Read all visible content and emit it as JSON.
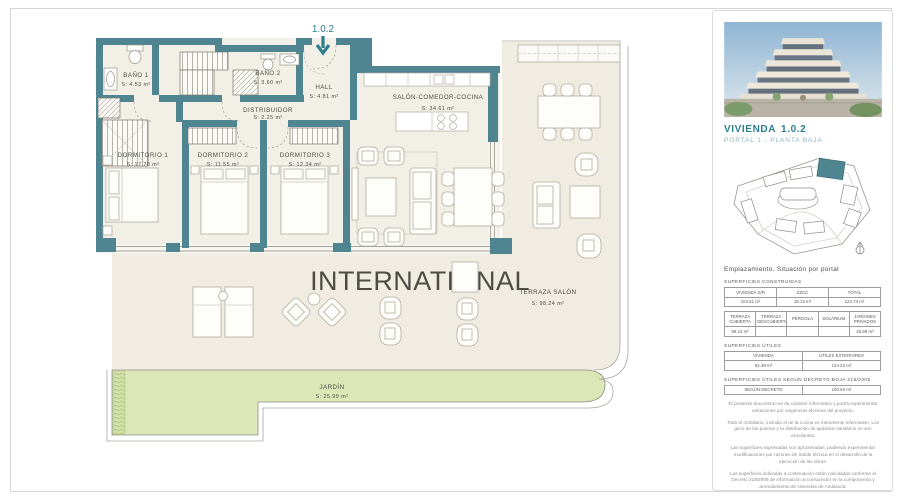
{
  "plan": {
    "unit_label": "1.0.2",
    "watermark": "INTERNATIONAL",
    "rooms": [
      {
        "name": "BAÑO 1",
        "area": "S: 4.53  m²"
      },
      {
        "name": "BAÑO 2",
        "area": "S: 3.60  m²"
      },
      {
        "name": "HALL",
        "area": "S: 4.81  m²"
      },
      {
        "name": "DISTRIBUIDOR",
        "area": "S: 2.25  m²"
      },
      {
        "name": "DORMITORIO 1",
        "area": "S: 17.70 m²"
      },
      {
        "name": "DORMITORIO 2",
        "area": "S: 11.55 m²"
      },
      {
        "name": "DORMITORIO 3",
        "area": "S: 12.34 m²"
      },
      {
        "name": "SALÓN-COMEDOR-COCINA",
        "area": "S: 34.61  m²"
      },
      {
        "name": "TERRAZA SALÓN",
        "area": "S: 98.24  m²"
      },
      {
        "name": "JARDÍN",
        "area": "S: 25.99  m²"
      }
    ]
  },
  "sidebar": {
    "title": "VIVIENDA",
    "unit_number": "1.0.2",
    "subtitle": "PORTAL 1 - PLANTA BAJA",
    "siteplan_caption": "Emplazamiento. Situación por portal",
    "sections": {
      "constructed": "SUPERFICIES CONSTRUIDAS",
      "useful": "SUPERFICIES ÚTILES",
      "decree": "SUPERFICIES ÚTILES SEGÚN DECRETO BOJA 218/2005"
    },
    "tables": {
      "constructed": {
        "headers": [
          "VIVIENDA S/R",
          "ZZCC",
          "TOTAL"
        ],
        "values": [
          "104.61 m²",
          "18.13 m²",
          "122.74 m²"
        ]
      },
      "exterior": {
        "headers": [
          "TERRAZA CUBIERTA",
          "TERRAZA DESCUBIERTA",
          "PÉRGOLA",
          "SOLÁRIUM",
          "JARDINES PRIVADOS"
        ],
        "values": [
          "98.24 m²",
          "",
          "",
          "",
          "25.99 m²"
        ]
      },
      "useful": {
        "headers": [
          "VIVIENDA",
          "ÚTILES EXTERIORES"
        ],
        "values": [
          "91.39 m²",
          "124.23 m²"
        ]
      },
      "decree": {
        "headers": [
          "SEGÚN DECRETO"
        ],
        "values": [
          "100.53 m²"
        ]
      }
    },
    "disclaimers": [
      "El presente documento es de carácter informativo y podrá experimentar variaciones por exigencias técnicas del  proyecto.",
      "Todo el mobiliario, incluido el de la cocina es meramente informativo. Los giros de las puertas y la distribución de aparatos sanitarios no son vinculantes.",
      "Las superficies expresadas son aproximadas, pudiendo experimentar modificaciones por razones de índole técnica en el desarrollo de la ejecución de las obras.",
      "Las superficies indicadas a continuación están calculadas conforme al Decreto 218/2005 de información al consumidor en la compraventa  y arrendamiento de viviendas de Andalucía."
    ],
    "colors": {
      "accent_teal": "#2e7f8e",
      "wall_teal": "#4e8591",
      "garden_green": "#dbe7b6"
    }
  }
}
